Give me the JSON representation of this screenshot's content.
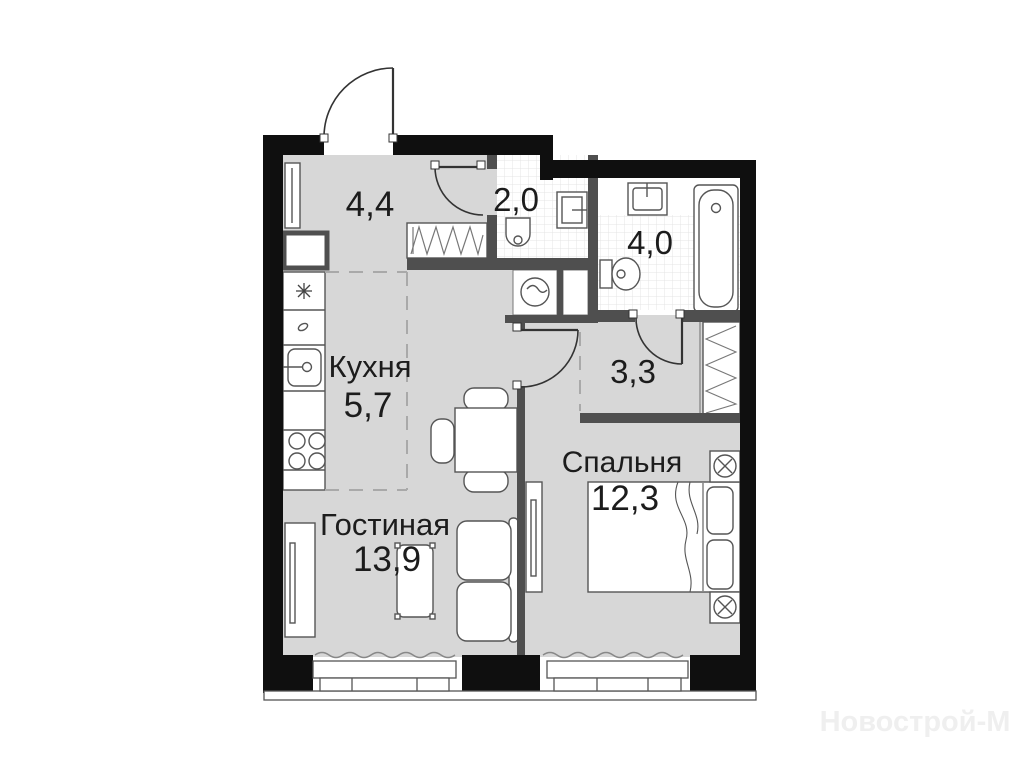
{
  "plan": {
    "type": "apartment-floor-plan",
    "rooms": {
      "hallway": {
        "area": "4,4"
      },
      "wc": {
        "area": "2,0"
      },
      "bathroom": {
        "area": "4,0"
      },
      "kitchen": {
        "name": "Кухня",
        "area": "5,7"
      },
      "corridor": {
        "area": "3,3"
      },
      "living": {
        "name": "Гостиная",
        "area": "13,9"
      },
      "bedroom": {
        "name": "Спальня",
        "area": "12,3"
      }
    },
    "fixtures": [
      "entrance-door",
      "wardrobe",
      "toilet",
      "washbasin",
      "bathtub",
      "washing-machine",
      "fridge",
      "kitchen-sink",
      "stove",
      "dining-table",
      "sofa",
      "coffee-table",
      "tv-stand",
      "double-bed",
      "nightstand-lamps",
      "windows"
    ],
    "colors": {
      "outer_wall": "#0f0f0f",
      "inner_wall": "#4f4f4f",
      "floor": "#d7d7d7",
      "furniture_line": "#555555",
      "tile_line": "#e4e4e4",
      "dash_line": "#a9a9a9",
      "label": "#1c1c1c",
      "watermark": "#efefef"
    }
  },
  "watermark": "Новострой-М"
}
